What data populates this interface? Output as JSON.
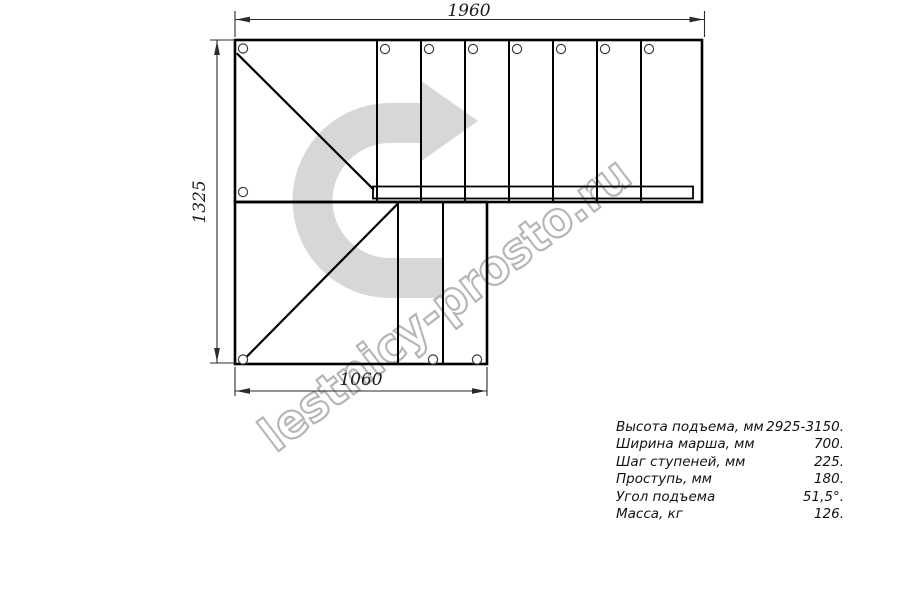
{
  "drawing": {
    "watermark": "lestnicy-prosto.ru",
    "dimensions": {
      "top": "1960",
      "left": "1325",
      "bottom": "1060"
    },
    "colors": {
      "arrow_fill": "#d7d7d7",
      "watermark_stroke": "#b5b5b5",
      "line": "#000000",
      "dim_line": "#2b2b2b"
    }
  },
  "specs": {
    "rows": [
      {
        "label": "Высота подъема, мм",
        "value": "2925-3150."
      },
      {
        "label": "Ширина марша, мм",
        "value": "700."
      },
      {
        "label": "Шаг ступеней, мм",
        "value": "225."
      },
      {
        "label": "Проступь, мм",
        "value": "180."
      },
      {
        "label": "Угол подъема",
        "value": "51,5°."
      },
      {
        "label": "Масса, кг",
        "value": "126."
      }
    ]
  }
}
